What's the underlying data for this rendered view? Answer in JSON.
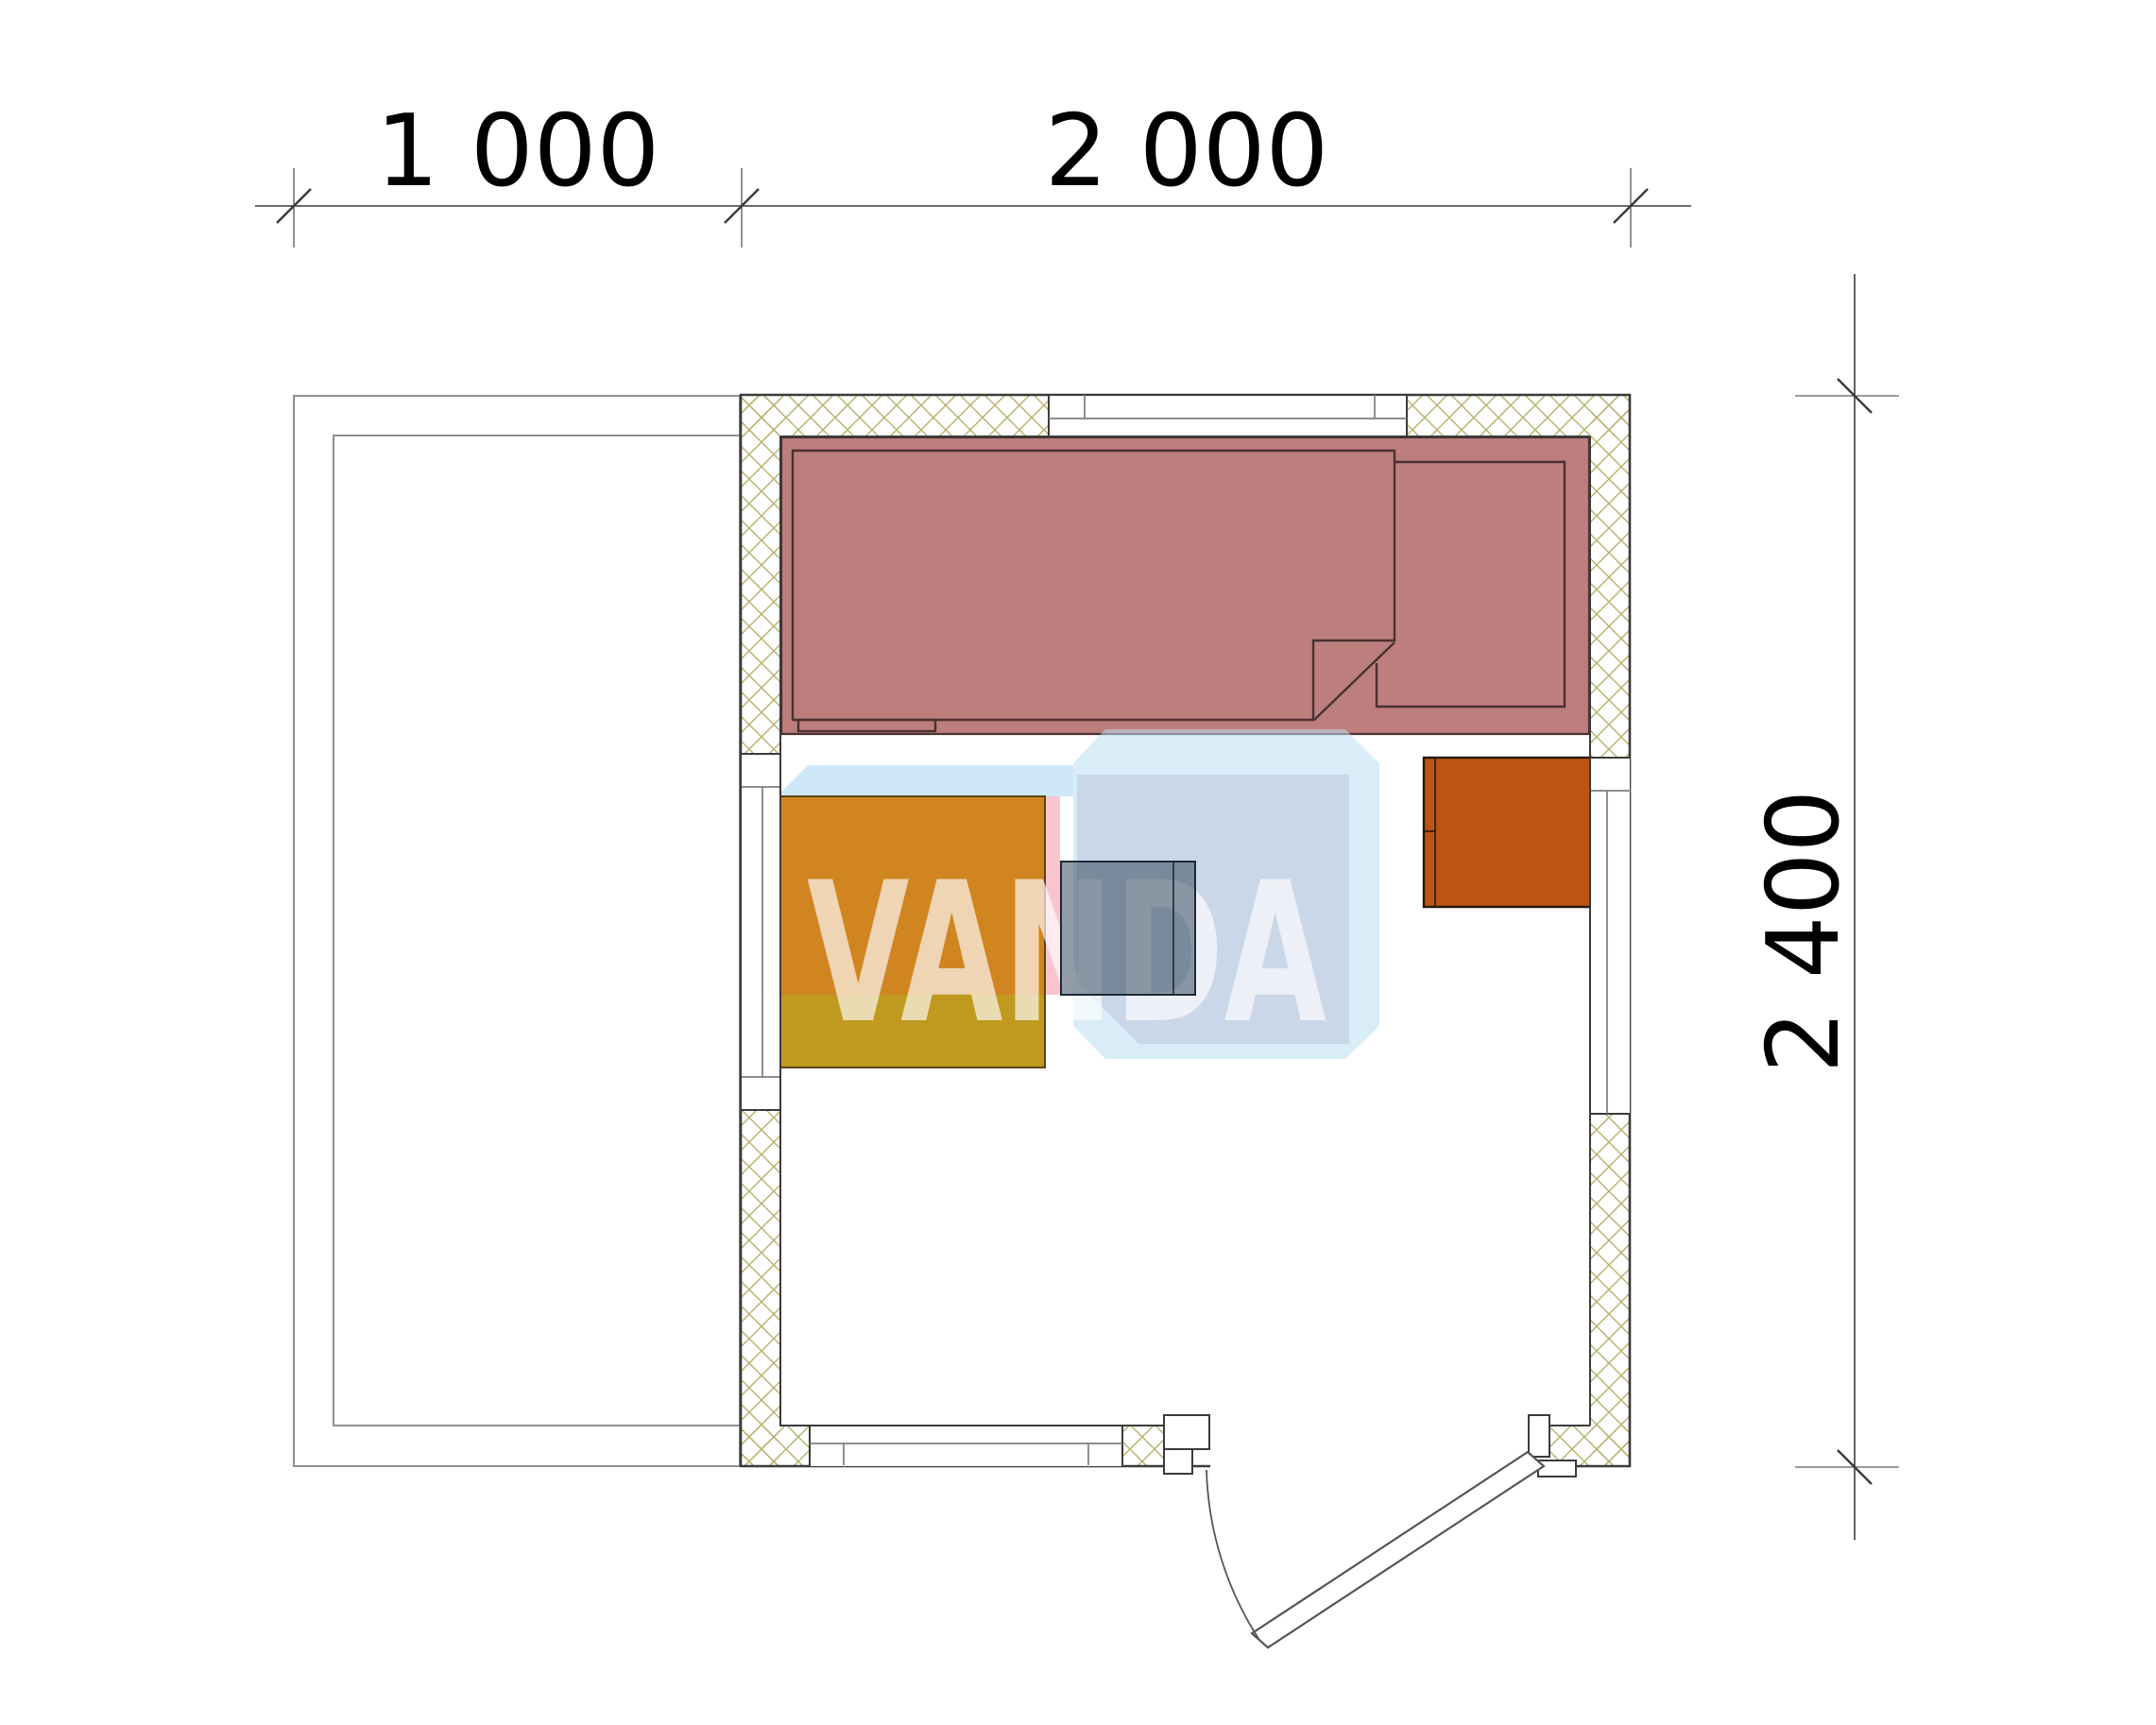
{
  "watermark": {
    "text": "VANDA"
  },
  "dimensions": {
    "top_left": "1 000",
    "top_right": "2 000",
    "right": "2 400"
  },
  "colors": {
    "wall_line": "#3b3b3b",
    "frame_line": "#7d7d7d",
    "terrace_line": "#8f8f8f",
    "dim_line": "#3a3a3a",
    "dim_text": "#000000",
    "hatch_line": "#b6b06a",
    "platform": "#bd7e7e",
    "platform_line": "#4a3131",
    "table_top": "#d08521",
    "table_front": "#bf9a1e",
    "table_line": "#5b4413",
    "cabinet": "#bc5512",
    "cabinet_line": "#26180b",
    "stove": "rgba(47,67,88,0.52)",
    "stove_line": "#1e2a36",
    "watermark_blue": "rgba(168,214,240,0.55)",
    "watermark_sil": "rgba(186,222,243,0.55)",
    "watermark_face": "rgba(196,209,228,0.80)",
    "watermark_pink": "rgba(247,178,188,0.75)",
    "watermark_text": "rgba(255,255,255,0.66)",
    "door_line": "#555555"
  }
}
